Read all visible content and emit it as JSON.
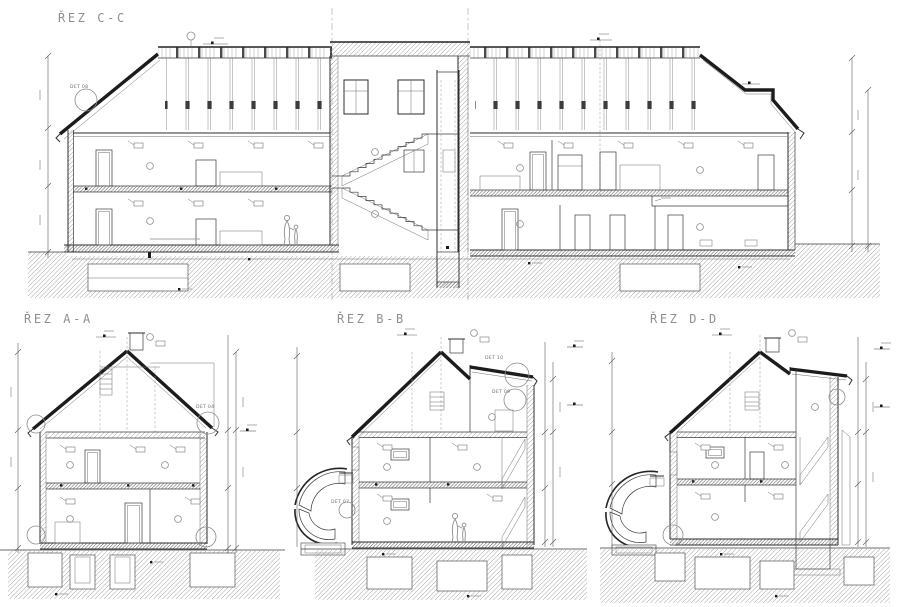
{
  "page": {
    "background": "#ffffff"
  },
  "drawing": {
    "ink": "#2e2e2e",
    "title_color": "#8f8f8f",
    "hatch_color": "#8a8a8a"
  },
  "sections": {
    "c": {
      "title": "ŘEZ C-C"
    },
    "a": {
      "title": "ŘEZ A-A"
    },
    "b": {
      "title": "ŘEZ B-B"
    },
    "d": {
      "title": "ŘEZ D-D"
    }
  },
  "details": {
    "det08": "DET 08",
    "det04": "DET 04",
    "det10": "DET 10",
    "det09": "DET 09",
    "det07": "DET 07"
  }
}
